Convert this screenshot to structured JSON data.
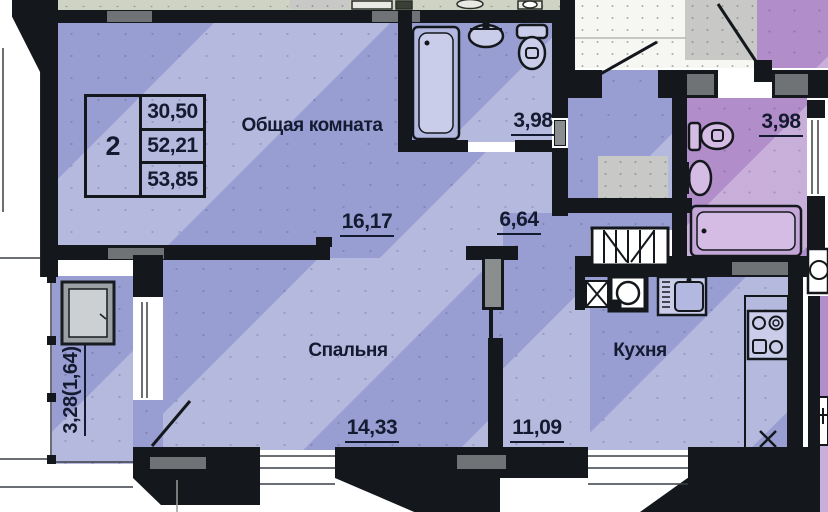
{
  "unit_table": {
    "rooms_count": "2",
    "values": [
      "30,50",
      "52,21",
      "53,85"
    ]
  },
  "labels": {
    "living_room": {
      "name": "Общая комната",
      "area": "16,17"
    },
    "bathroom": {
      "area": "3,98"
    },
    "hallway": {
      "area": "6,64"
    },
    "bedroom": {
      "name": "Спальня",
      "area": "14,33"
    },
    "kitchen": {
      "name": "Кухня",
      "area": "11,09"
    },
    "adjacent_bathroom": {
      "area": "3,98"
    },
    "balcony": {
      "area": "3,28(1,64)"
    }
  },
  "colors": {
    "apartment_fill": "#989ed1",
    "adjacent_fill": "#b18dca",
    "wall": "#14181c",
    "lintel": "#6f7376",
    "text": "#141b30"
  }
}
